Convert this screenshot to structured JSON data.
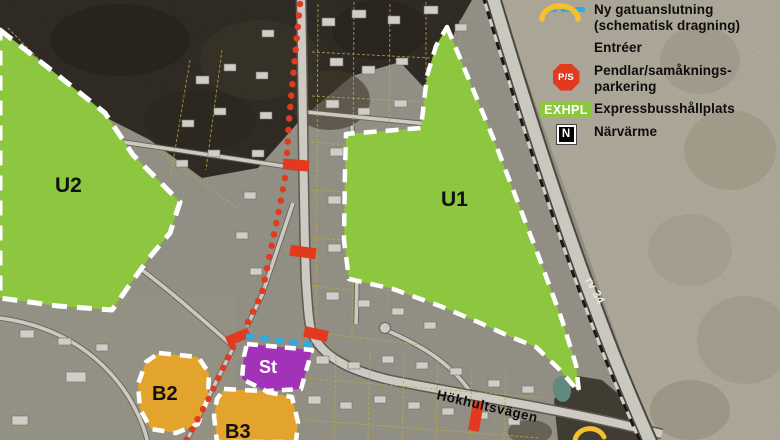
{
  "legend": {
    "items": [
      {
        "id": "new-street-connection",
        "symbol": "dashed-line-icon",
        "label": "Ny gatuanslutning (schematisk dragning)"
      },
      {
        "id": "entrances",
        "symbol": "entrance-arc-icon",
        "label": "Entréer"
      },
      {
        "id": "commuter-carpool-parking",
        "symbol": "ps-octagon-icon",
        "badge": "P/S",
        "label": "Pendlar/samåknings-parkering"
      },
      {
        "id": "express-bus-stop",
        "symbol": "exhpl-box-icon",
        "badge": "EXHPL",
        "label": "Expressbusshållplats"
      },
      {
        "id": "district-heating",
        "symbol": "n-square-icon",
        "badge": "N",
        "label": "Närvärme"
      }
    ]
  },
  "map": {
    "zone_labels": {
      "u2": "U2",
      "u1": "U1",
      "st": "St",
      "b2": "B2",
      "b3": "B3"
    },
    "road_labels": {
      "hokhultsvagen": "Hökhultsvägen",
      "rv34": "rv 34"
    }
  },
  "colors": {
    "zone_green": "#8DC63F",
    "zone_gold": "#E2A42C",
    "zone_purple": "#A233B8",
    "marker_red": "#E13A1F",
    "new_street_cyan": "#2BACE2",
    "entrance_yellow": "#F5C02F"
  }
}
